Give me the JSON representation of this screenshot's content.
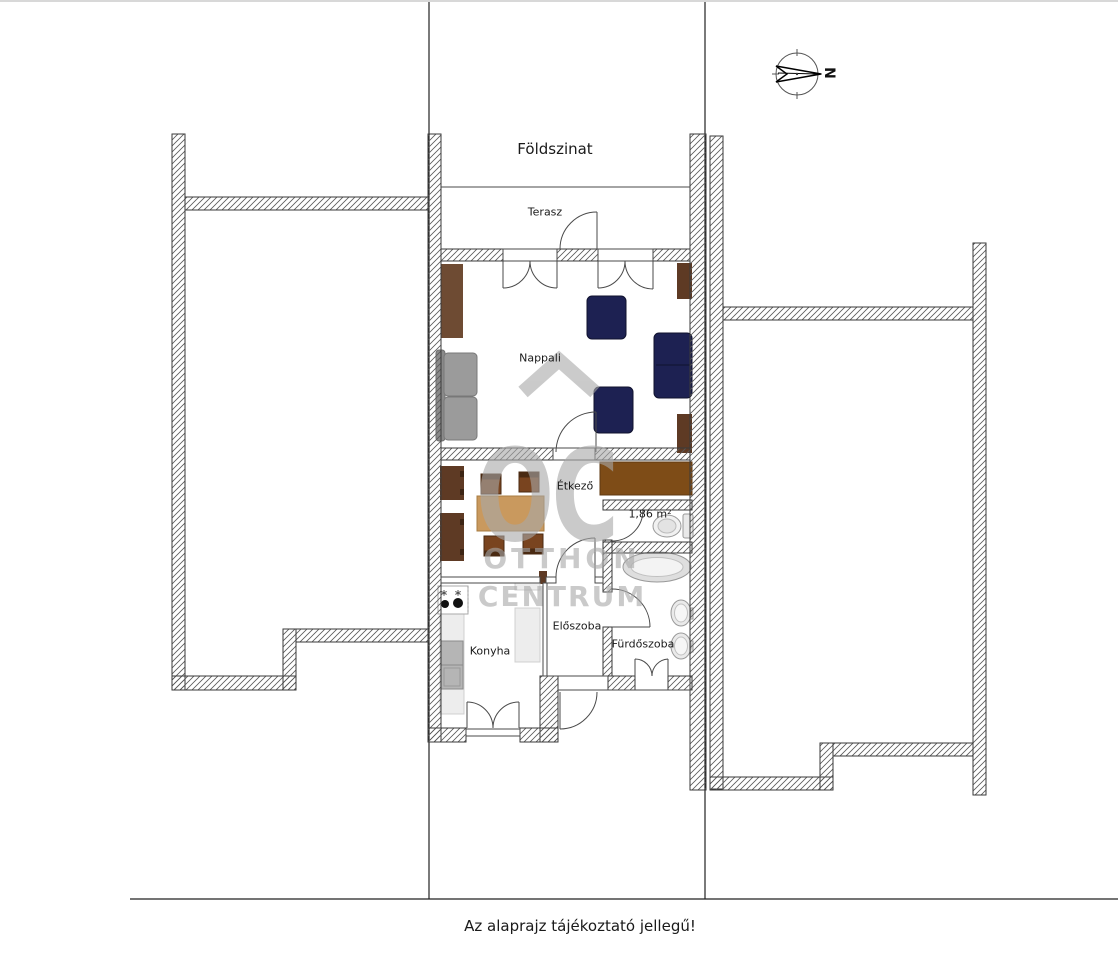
{
  "title": "Földszinat",
  "footer": "Az alaprajz tájékoztató jellegű!",
  "compass": {
    "north_label": "N"
  },
  "rooms": {
    "terasz": "Terasz",
    "nappali": "Nappali",
    "etkezo": "Étkező",
    "wc_area_label": "1,86 m²",
    "konyha": "Konyha",
    "eloszoba": "Előszoba",
    "furdoszoba": "Fürdőszoba"
  },
  "watermark": {
    "logo": "OC",
    "line1": "OTTHON",
    "line2": "CENTRUM"
  },
  "colors": {
    "navy": "#1d2152",
    "brown_cabinet": "#6e4b33",
    "brown_dark": "#5e3a24",
    "brown_long_cabinet": "#7e4c17",
    "table_tan": "#c9995e",
    "chair_brown": "#79441f",
    "sofa_gray": "#9b9b9b",
    "sofa_gray_dark": "#8a8a8a",
    "counter_gray": "#ededed",
    "fridge_gray": "#b5b5b5",
    "watermark_gray": "#a8a8a8"
  }
}
